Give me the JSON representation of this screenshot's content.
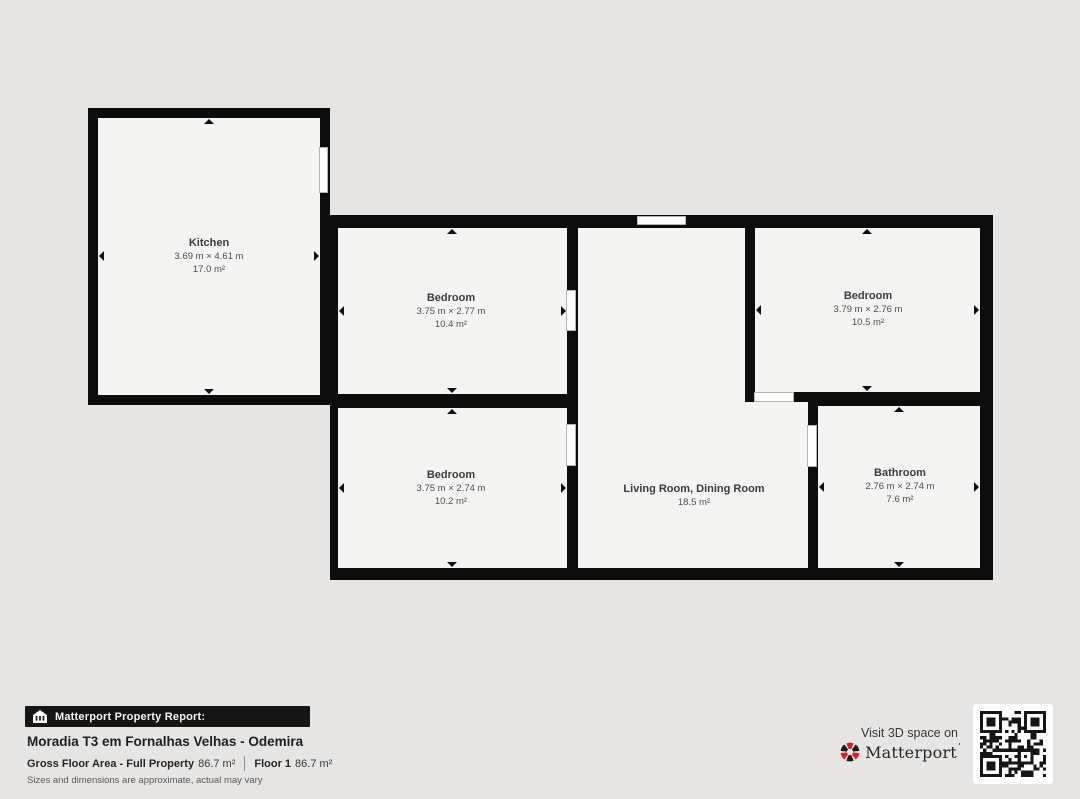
{
  "floorplan": {
    "rooms": {
      "kitchen": {
        "name": "Kitchen",
        "dimensions": "3.69 m × 4.61 m",
        "area": "17.0 m²"
      },
      "bedroom_top": {
        "name": "Bedroom",
        "dimensions": "3.75 m × 2.77 m",
        "area": "10.4 m²"
      },
      "bedroom_right": {
        "name": "Bedroom",
        "dimensions": "3.79 m × 2.76 m",
        "area": "10.5 m²"
      },
      "bedroom_bottom": {
        "name": "Bedroom",
        "dimensions": "3.75 m × 2.74 m",
        "area": "10.2 m²"
      },
      "living": {
        "name": "Living Room, Dining Room",
        "area": "18.5 m²"
      },
      "bathroom": {
        "name": "Bathroom",
        "dimensions": "2.76 m × 2.74 m",
        "area": "7.6 m²"
      }
    }
  },
  "report": {
    "badge_label": "Matterport Property Report:",
    "title": "Moradia T3 em Fornalhas Velhas - Odemira",
    "gross_label": "Gross Floor Area - Full Property",
    "gross_value": "86.7 m²",
    "floor_label": "Floor 1",
    "floor_value": "86.7 m²",
    "disclaimer": "Sizes and dimensions are approximate, actual may vary"
  },
  "promo": {
    "visit_text": "Visit 3D space on",
    "brand": "Matterport",
    "trademark": "’"
  },
  "icons": {
    "house-icon": "white house with column slots",
    "matterport-logo-icon": "red and black pinwheel",
    "dimension-arrow-icon": "small black triangle",
    "qr-code": "scannable QR pattern"
  },
  "colors": {
    "background": "#e6e5e4",
    "wall": "#0d0d0d",
    "room_fill": "#f4f4f3",
    "matterport_red": "#d71f29",
    "badge_bg": "#161616",
    "qr_dark": "#161616"
  }
}
